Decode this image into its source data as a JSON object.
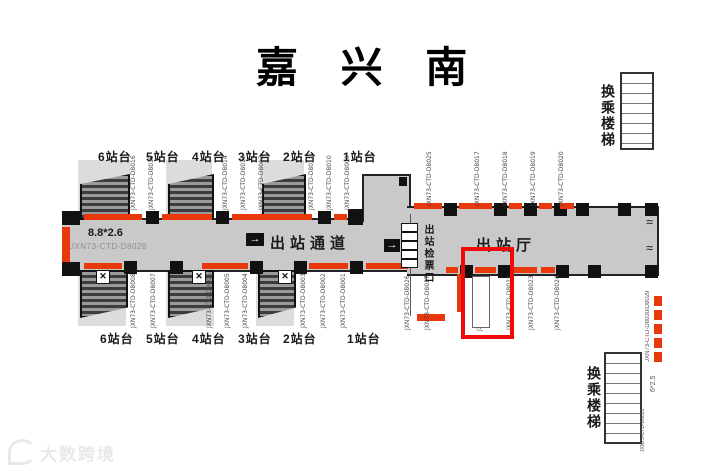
{
  "title": "嘉 兴 南",
  "colors": {
    "accent_red": "#e8380c",
    "highlight_red": "#ee0a0a",
    "floor_gray": "#c9c9c9",
    "band_gray": "#dcdcdc",
    "ink": "#1a1a1a"
  },
  "labels": {
    "exit_corridor": "出站通道",
    "exit_hall": "出站厅",
    "exit_gates": "出站检票口",
    "transfer_stairs_top": "换乘楼梯",
    "transfer_stairs_bottom": "换乘楼梯",
    "arrow_right": "→",
    "x_mark": "✕",
    "door_squiggle": "≀≀"
  },
  "platforms": {
    "top": [
      "6站台",
      "5站台",
      "4站台",
      "3站台",
      "2站台",
      "1站台"
    ],
    "bottom": [
      "6站台",
      "5站台",
      "4站台",
      "3站台",
      "2站台",
      "1站台"
    ]
  },
  "ad_positions": {
    "top_corridor": [
      "JXN73-CTD-D8016",
      "JXN73-CTD-D8015",
      "JXN73-CTD-D8014",
      "JXN73-CTD-D8013",
      "JXN73-CTD-D8012",
      "JXN73-CTD-D8011",
      "JXN73-CTD-D8010",
      "JXN73-CTD-D8009"
    ],
    "bottom_corridor": [
      "JXN73-CTD-D8008",
      "JXN73-CTD-D8007",
      "JXN73-CTD-D8006",
      "JXN73-CTD-D8005",
      "JXN73-CTD-D8004",
      "JXN73-CTD-D8003",
      "JXN73-CTD-D8002",
      "JXN73-CTD-D8001"
    ],
    "top_hall": [
      "JXN73-CTD-D8025",
      "JXN73-CTD-D8017",
      "JXN73-CTD-D8018",
      "JXN73-CTD-D8019",
      "JXN73-CTD-D8020"
    ],
    "bottom_hall": [
      "JXN73-CTD-D8026",
      "JXN73-CTD-D8027",
      "JXN73-CTD-D8021",
      "JXN73-CTD-D8022",
      "JXN73-CTD-D8023",
      "JXN73-CTD-D8024"
    ],
    "right_escalator_code": "JXN73-CTD-D8030/D8029",
    "right_escalator_size": "6*2.5",
    "bottom_stairs_code": "JXN73-CTD-D8031"
  },
  "left_position": {
    "size": "8.8*2.6",
    "code": "JXN73-CTD-D8028"
  },
  "highlighted_position": {
    "code": "JXN73-CTD-D8021"
  },
  "watermark": "大数跨境"
}
